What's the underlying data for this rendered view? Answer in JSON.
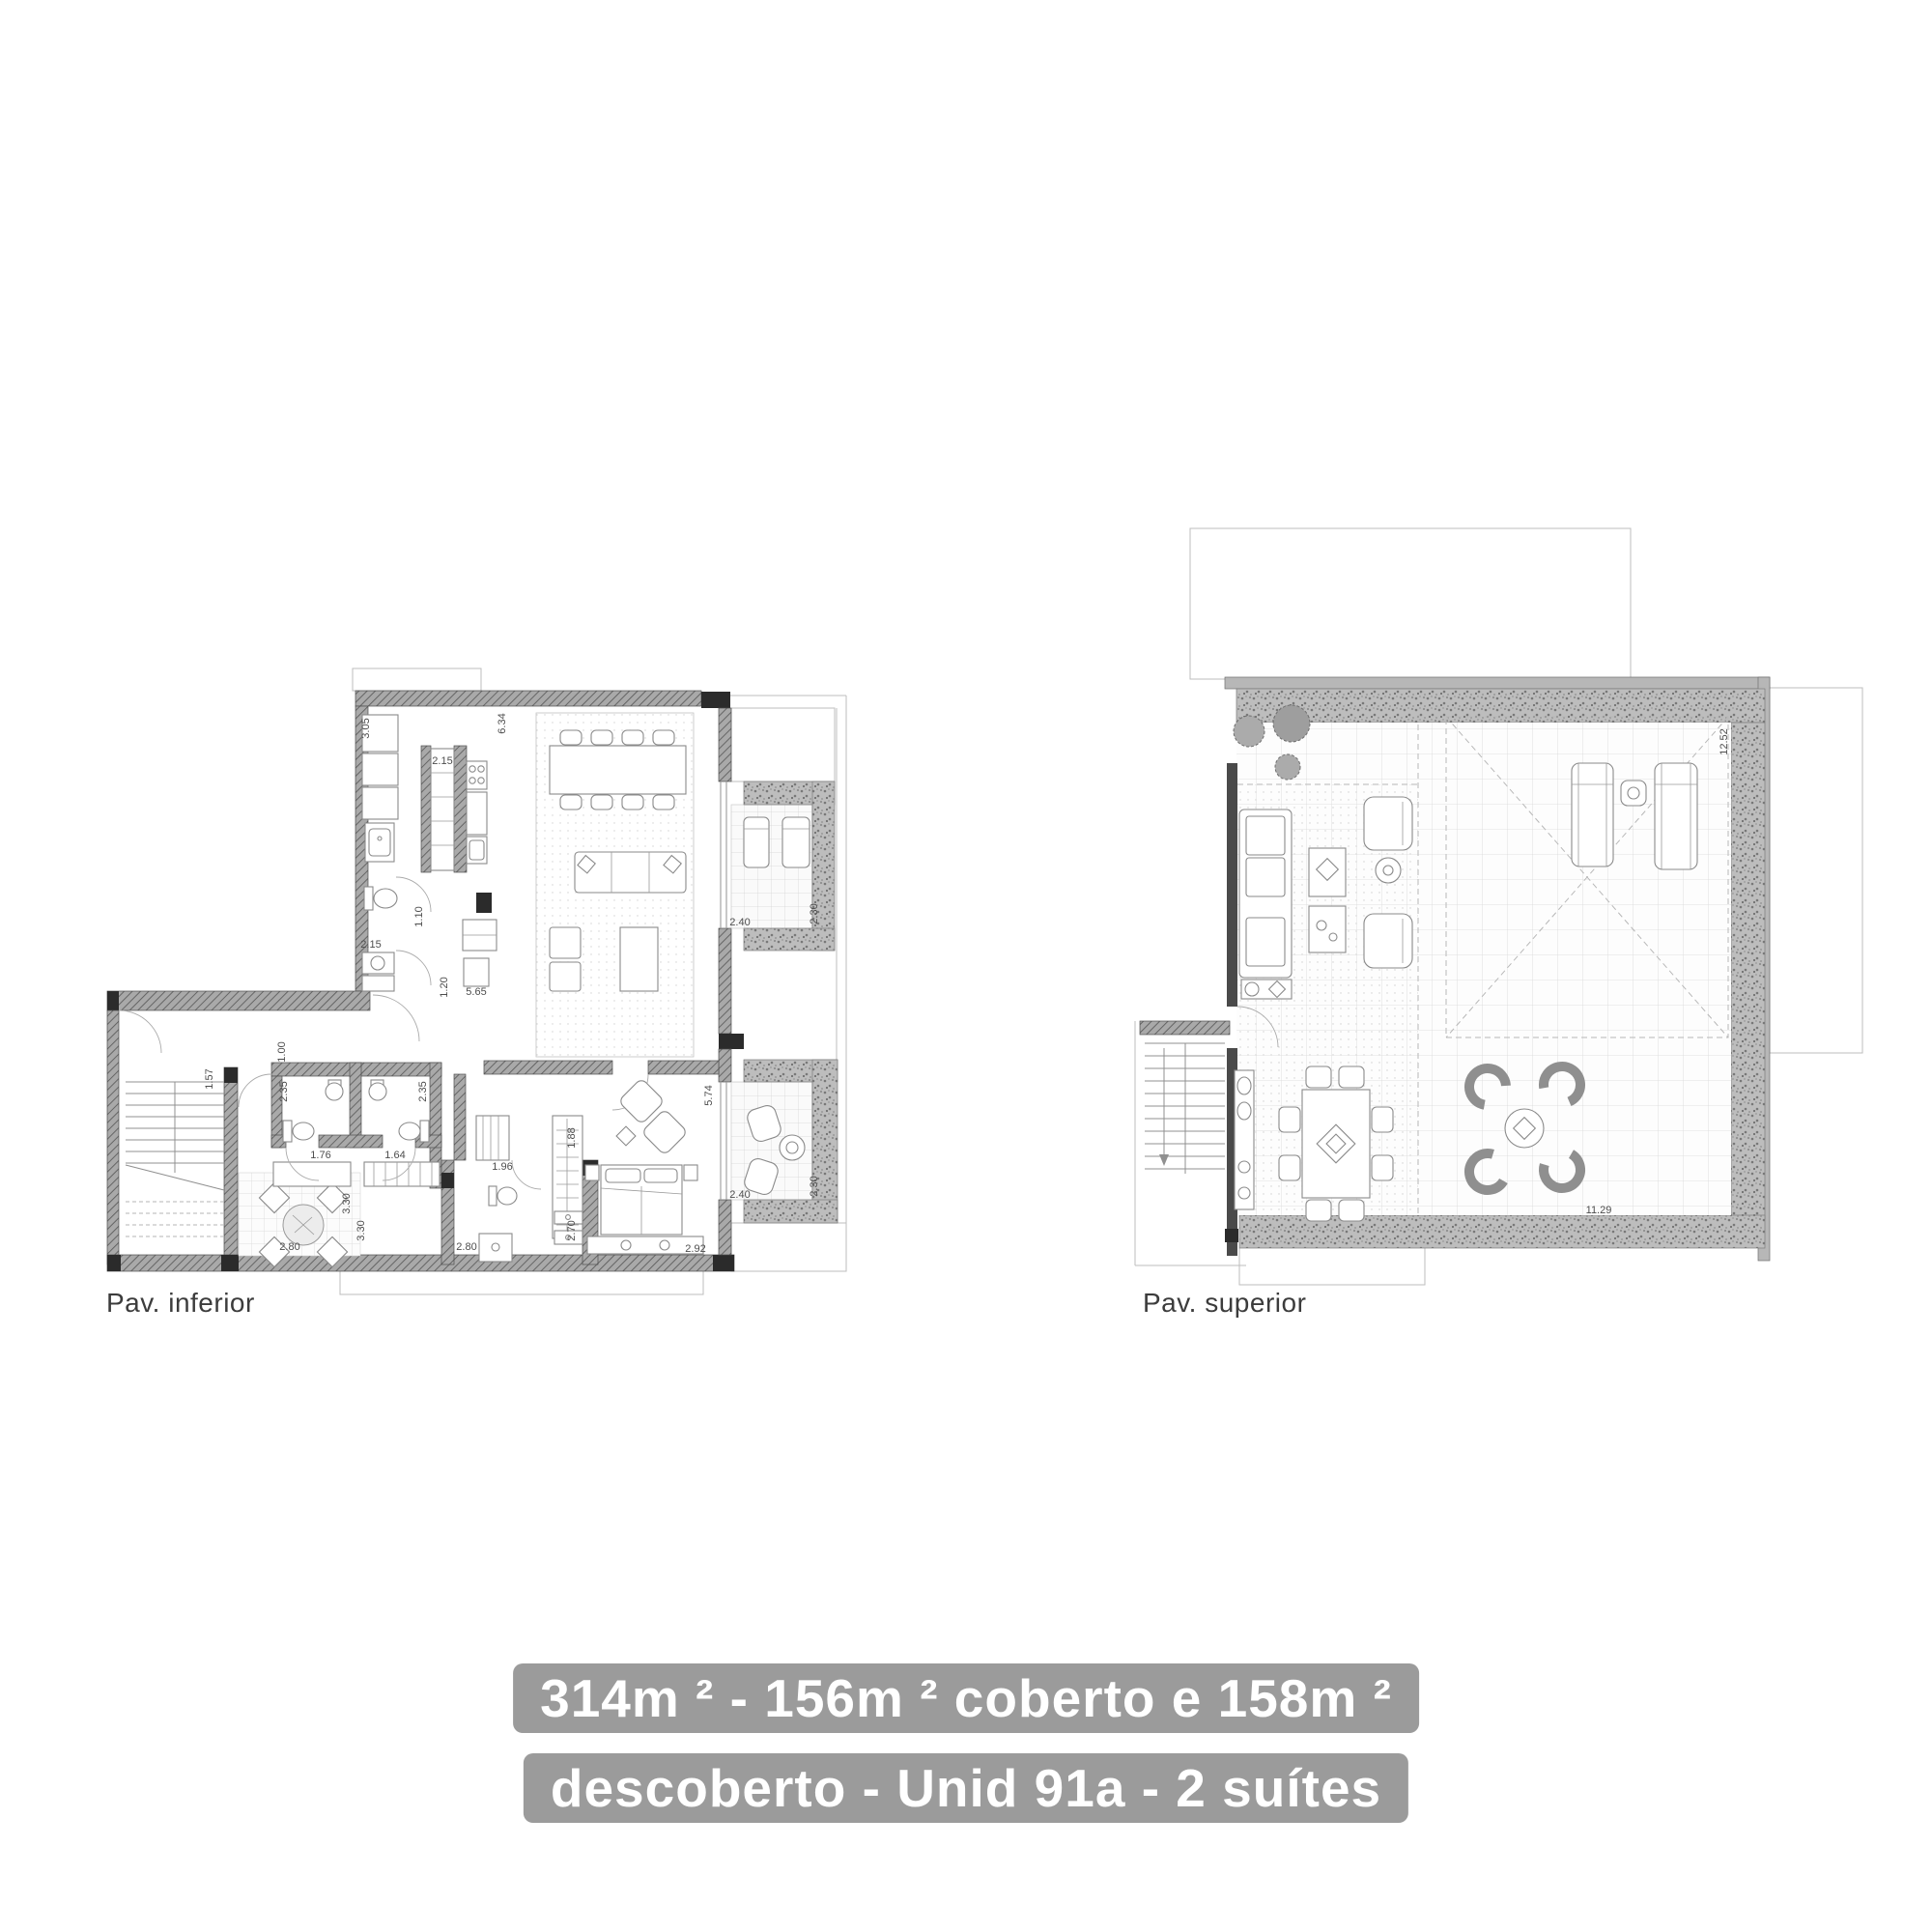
{
  "page": {
    "background": "#ffffff",
    "linework_color": "#8a8a8a",
    "wall_color": "#5d5d5d"
  },
  "plans": {
    "inferior": {
      "label": "Pav. inferior",
      "dims": {
        "d_305": "3.05",
        "d_215_pantry": "2.15",
        "d_634": "6.34",
        "d_110": "1.10",
        "d_215_wc": "2.15",
        "d_120": "1.20",
        "d_565": "5.65",
        "d_157": "1.57",
        "d_100": "1.00",
        "d_235_l": "2.35",
        "d_235_r": "2.35",
        "d_176": "1.76",
        "d_164": "1.64",
        "d_330_a": "3.30",
        "d_280_l": "2.80",
        "d_330_b": "3.30",
        "d_280_r": "2.80",
        "d_196": "1.96",
        "d_188": "1.88",
        "d_270": "2.70",
        "d_292": "2.92",
        "d_574": "5.74",
        "d_240_b1": "2.40",
        "d_230_b1": "2.30",
        "d_240_b2": "2.40",
        "d_230_b2": "2.30"
      }
    },
    "superior": {
      "label": "Pav. superior",
      "dims": {
        "d_1252": "12.52",
        "d_1129": "11.29"
      }
    }
  },
  "caption": {
    "line1": "314m ² - 156m ² coberto e 158m ²",
    "line2": "descoberto - Unid 91a - 2 suítes",
    "background": "#9b9b9b",
    "text_color": "#ffffff"
  }
}
